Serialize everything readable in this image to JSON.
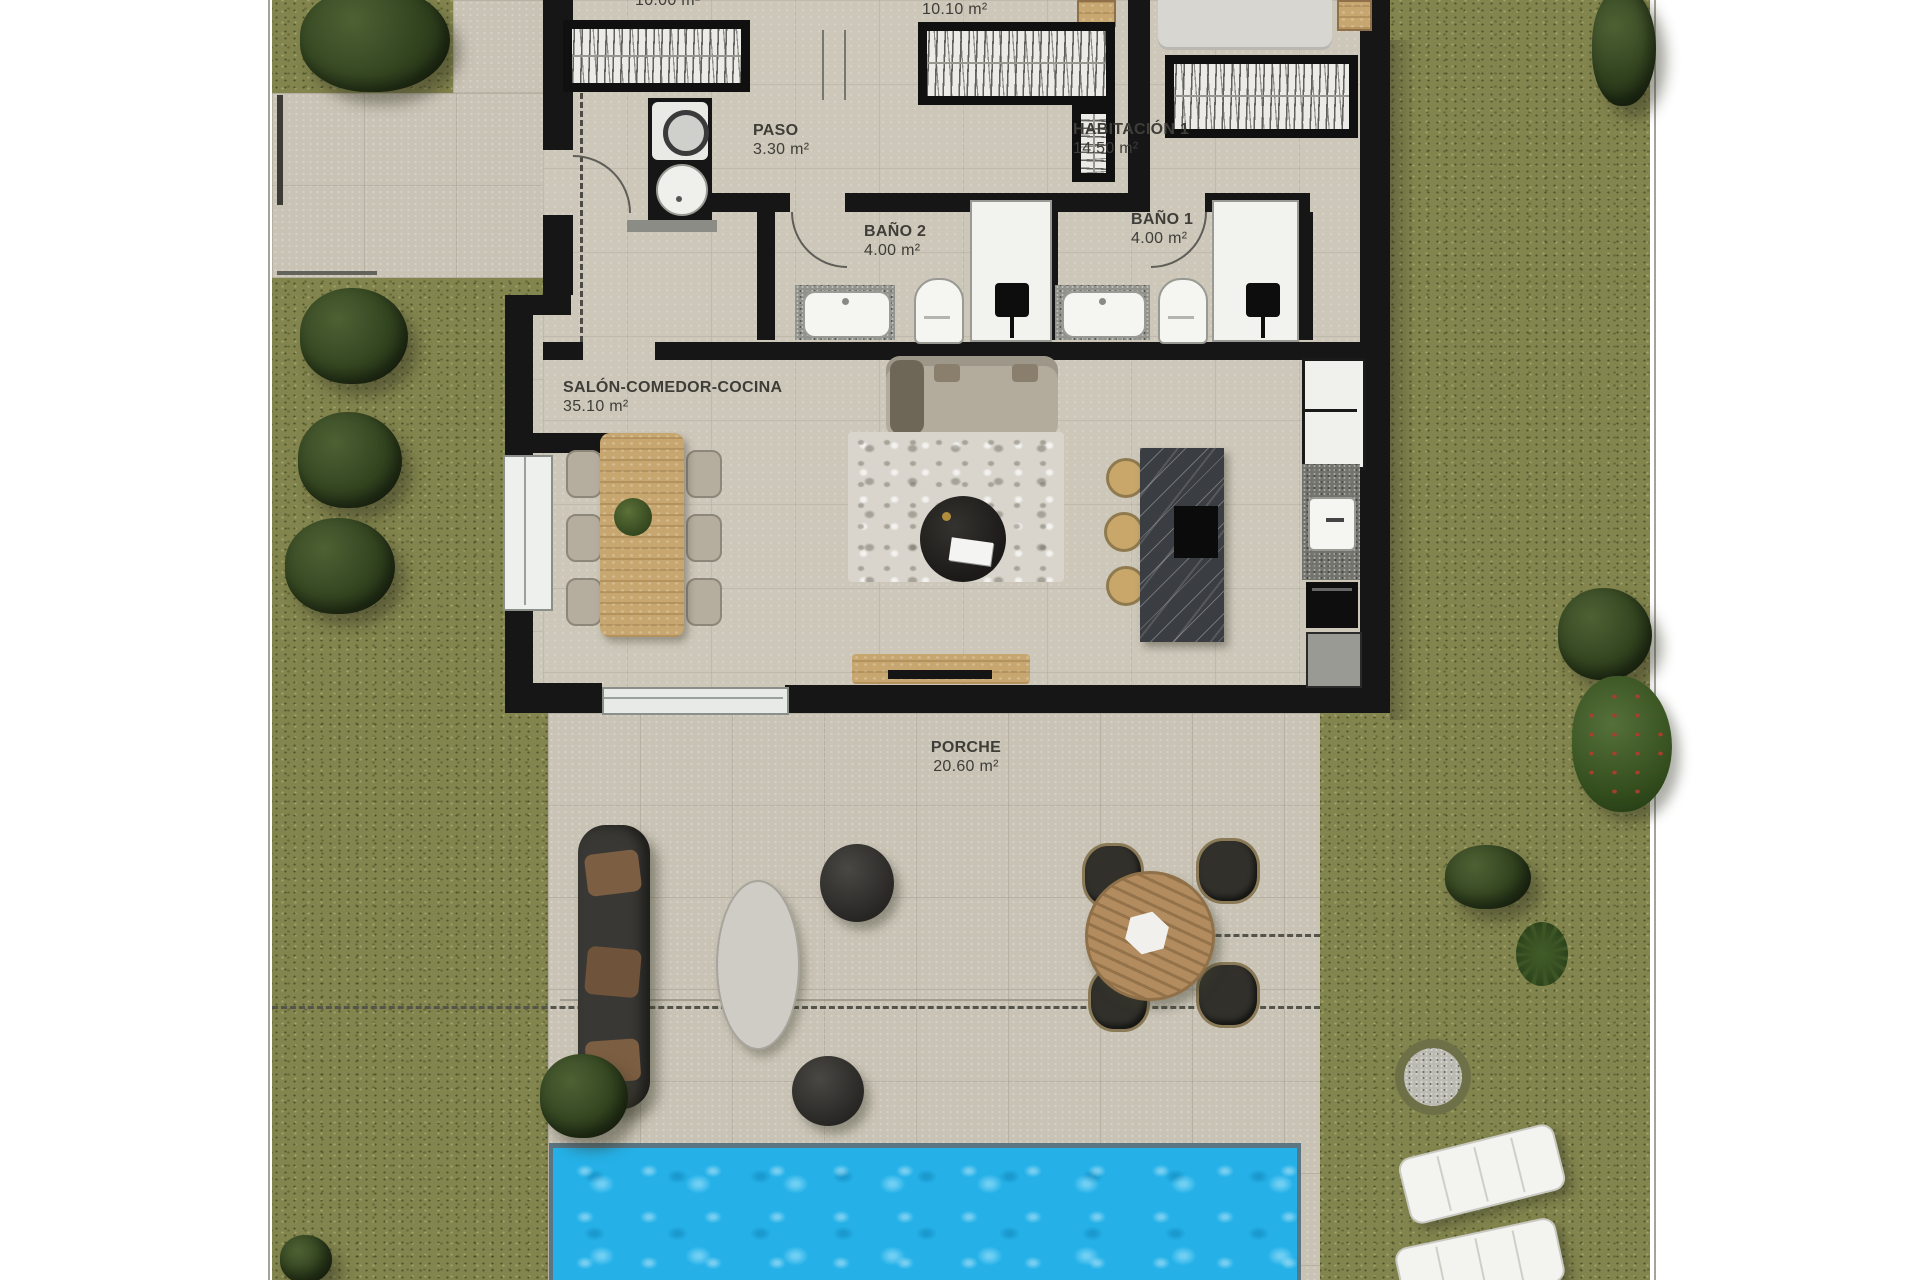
{
  "plan": {
    "title": "villa-floor-plan",
    "rooms": {
      "dorm_a": {
        "name": "",
        "area": "10.00 m²"
      },
      "dorm_b": {
        "name": "",
        "area": "10.10 m²"
      },
      "hab1": {
        "name": "HABITACIÓN 1",
        "area": "14.50 m²"
      },
      "paso": {
        "name": "PASO",
        "area": "3.30 m²"
      },
      "bano2": {
        "name": "BAÑO 2",
        "area": "4.00 m²"
      },
      "bano1": {
        "name": "BAÑO 1",
        "area": "4.00 m²"
      },
      "salon": {
        "name": "SALÓN-COMEDOR-COCINA",
        "area": "35.10 m²"
      },
      "porche": {
        "name": "PORCHE",
        "area": "20.60 m²"
      }
    },
    "colors": {
      "grass": "#83854e",
      "paving": "#c9c3b5",
      "interior_floor": "#cdc7b9",
      "wall": "#161616",
      "pool_water": "#25b1e8",
      "wood": "#c7a76f",
      "island_marble": "#3a3d41",
      "label_text": "#3e3d38"
    }
  }
}
